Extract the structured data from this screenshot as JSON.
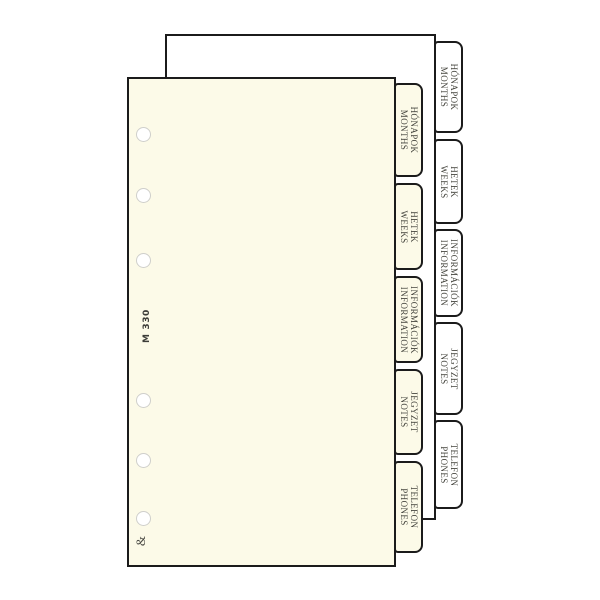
{
  "product": {
    "code": "M 330",
    "brand_mark": "&"
  },
  "tabs": [
    {
      "hu": "HÓNAPOK",
      "en": "MONTHS"
    },
    {
      "hu": "HETEK",
      "en": "WEEKS"
    },
    {
      "hu": "INFORMÁCIÓK",
      "en": "INFORMATION"
    },
    {
      "hu": "JEGYZET",
      "en": "NOTES"
    },
    {
      "hu": "TELEFON",
      "en": "PHONES"
    }
  ],
  "colors": {
    "front_sheet": "#fcfae8",
    "back_sheet": "#ffffff",
    "outline": "#1b1b1b",
    "label_text": "#45453e",
    "hole_ring": "#cfcfcb"
  }
}
